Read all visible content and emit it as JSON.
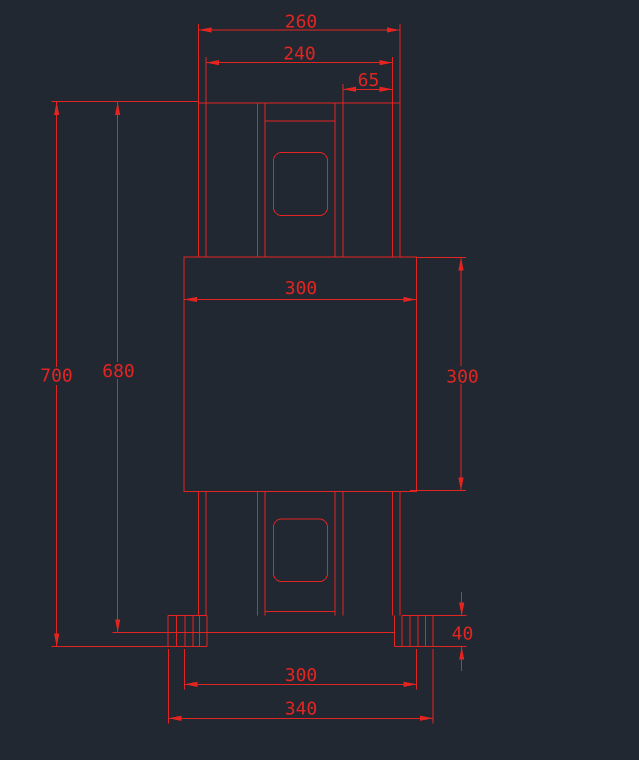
{
  "drawing": {
    "background_color": "#222831",
    "entity_color": "#e32522",
    "dimensions": {
      "top_flange_outer_width": "260",
      "top_flange_inner_width": "240",
      "top_web_to_flange_offset": "65",
      "body_width": "300",
      "body_height": "300",
      "overall_height": "700",
      "height_to_base_seat": "680",
      "base_plate_thickness": "40",
      "base_inner_width": "300",
      "base_outer_width": "340"
    }
  }
}
